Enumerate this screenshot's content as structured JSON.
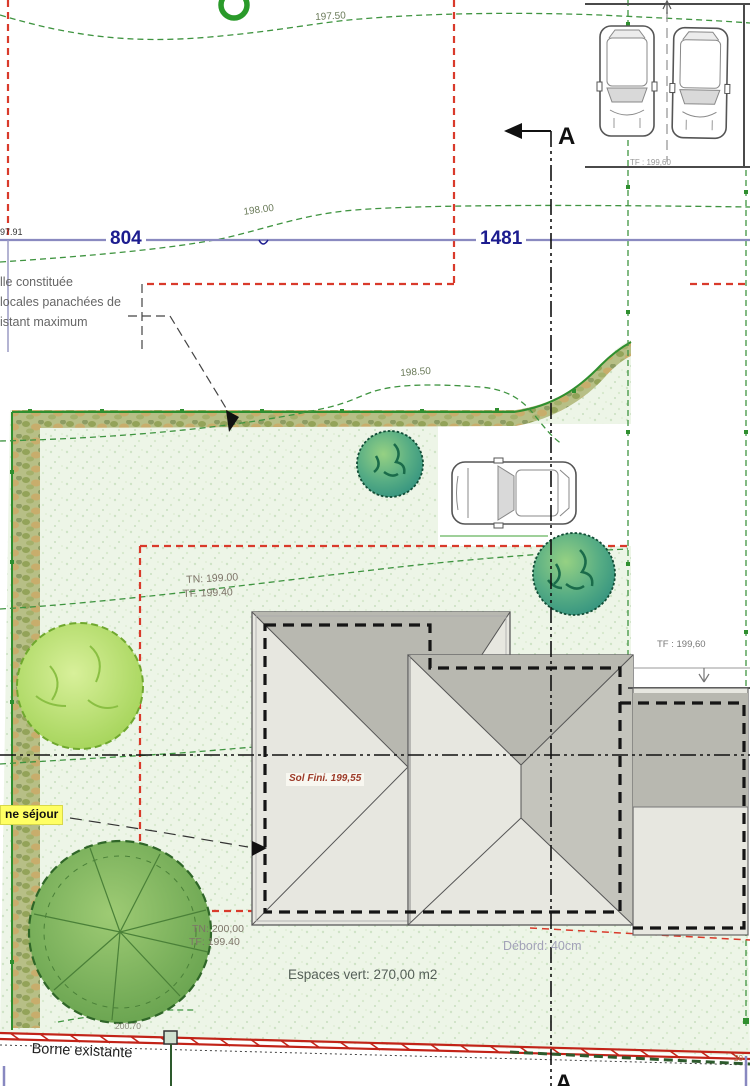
{
  "plan": {
    "parcels": {
      "left_number": "804",
      "right_number": "1481",
      "corner_point": "97.91"
    },
    "contour_labels": {
      "c197_50": "197.50",
      "c198_00": "198.00",
      "c198_50": "198.50",
      "c200_70": "200.70",
      "edge_partial": "20"
    },
    "section_marker": {
      "top": "A",
      "bottom": "A"
    },
    "hedge_note": {
      "line1": "lle constituée",
      "line2": "locales panachées de",
      "line3": "istant maximum"
    },
    "levels": {
      "tn_mid": "TN: 199.00",
      "tf_mid": "TF. 199.40",
      "tn_bottom": "TN: 200,00",
      "tf_bottom": "TF: 199.40",
      "tf_garage": "TF : 199,60",
      "tf_parking": "TF : 199,60",
      "sol_fini": "Sol Fini. 199,55"
    },
    "labels": {
      "sejour": "ne séjour",
      "espaces_vert": "Espaces vert: 270,00 m2",
      "debord": "Débord: 40cm",
      "borne": "Borne existante"
    },
    "icons": {
      "tree_round_teal": "round-tree-icon",
      "tree_light": "ornamental-tree-icon",
      "tree_large": "large-tree-icon",
      "car_top": "car-top-view-icon",
      "green_ring": "tree-ring-icon",
      "section_arrow": "section-cut-arrow-icon",
      "borne_marker": "boundary-marker-icon"
    },
    "colors": {
      "boundary_red": "#d93a2b",
      "parcel_blue_line": "#8a8ac0",
      "parcel_text": "#1c1c8f",
      "contour_green": "#3f9440",
      "boundary_green": "#2f8f2f",
      "lawn": "#edf5e7",
      "hedge": "#b7bf86",
      "roof_dark": "#b8b8b0",
      "roof_light": "#e7e7e0",
      "tree_teal": "#2f8f7f",
      "tree_light_green": "#b7df68",
      "tree_dark_green": "#6fae57",
      "highlight_yellow": "#ffff63",
      "section_black": "#111111"
    }
  }
}
